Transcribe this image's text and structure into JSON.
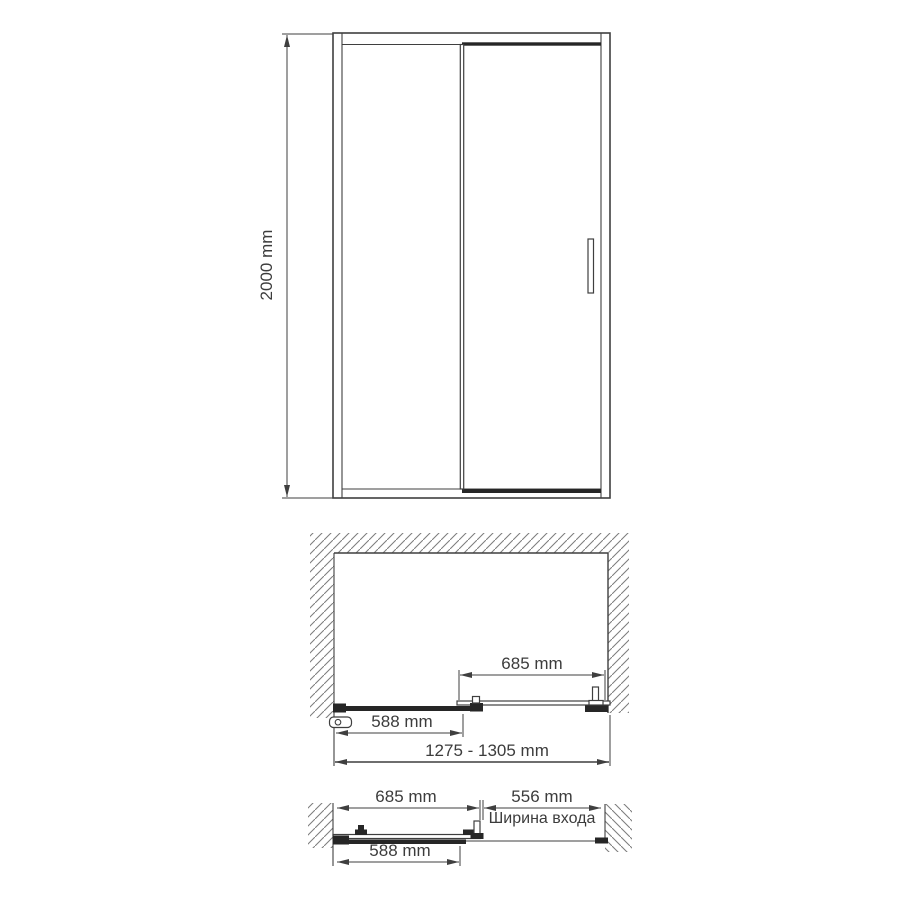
{
  "diagram": {
    "front_view": {
      "height_dim": "2000 mm"
    },
    "plan_closed": {
      "door_panel_dim": "685 mm",
      "fixed_panel_dim": "588 mm",
      "overall_width_dim": "1275 - 1305 mm"
    },
    "plan_open": {
      "door_panel_dim": "685 mm",
      "entrance_width_dim": "556 mm",
      "entrance_width_caption": "Ширина входа",
      "fixed_panel_dim": "588 mm"
    }
  },
  "colors": {
    "line": "#3f3f3f",
    "dark": "#262626",
    "hatch": "#7d7d7d",
    "text": "#3c3c3c",
    "bg": "#ffffff"
  }
}
